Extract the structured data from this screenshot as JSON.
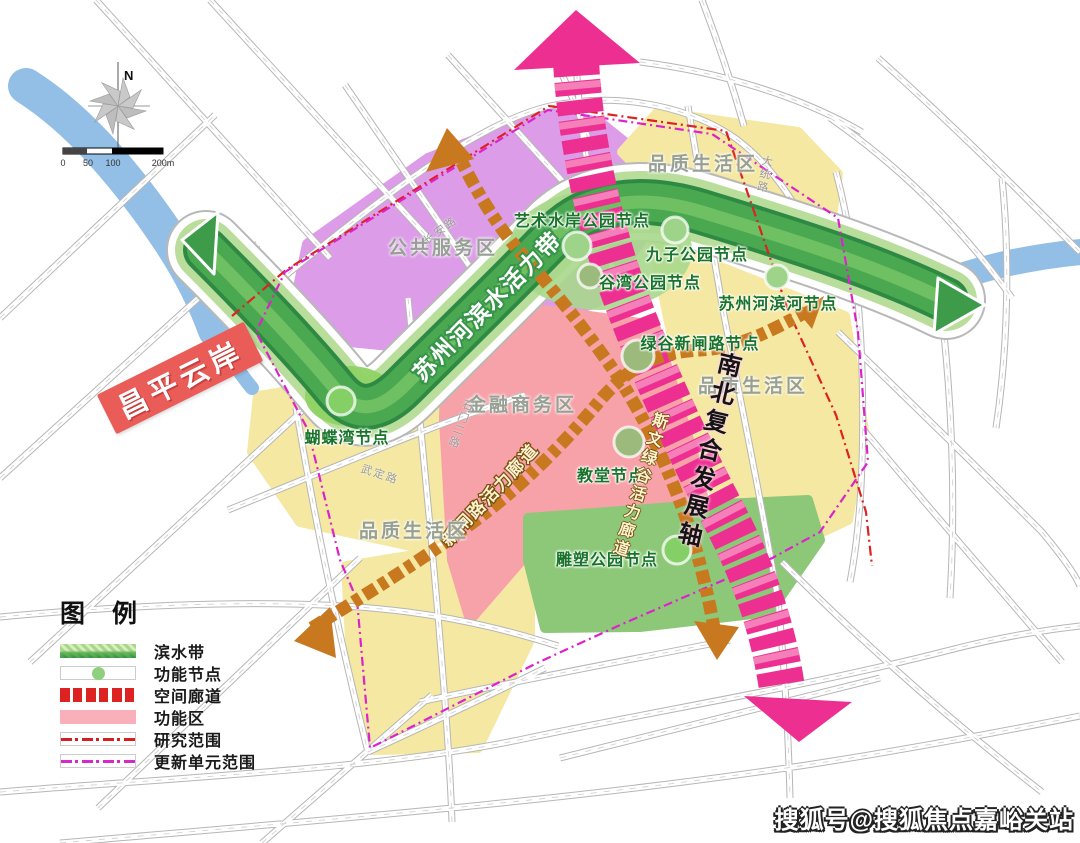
{
  "colors": {
    "river": "#93bfe6",
    "waterfront_band": "#3f9c49",
    "waterfront_band_light": "#b9dd9b",
    "axis_pink": "#ee2f92",
    "corridor_orange": "#c8791f",
    "zone_public_service": "#dc9ce8",
    "zone_quality_life": "#f5e8a3",
    "zone_finance": "#f6a2a8",
    "zone_park_green": "#8cc878",
    "node_green": "#84cf66",
    "boundary_research": "#dd2222",
    "boundary_update_unit": "#dd22cc",
    "banner_red": "#ea5c58"
  },
  "map": {
    "banner": "昌平云岸",
    "compass_north": "N",
    "scale_ticks": [
      "0",
      "50",
      "100",
      "200m"
    ],
    "waterfront_band_label": "苏州河滨水活力带",
    "axis_label": "南北复合发展轴",
    "corridor_xinzha_label": "新闸路活力廊道",
    "corridor_siwen_label": "斯文绿谷活力廊道",
    "zones": [
      {
        "label": "公共服务区"
      },
      {
        "label": "品质生活区"
      },
      {
        "label": "品质生活区"
      },
      {
        "label": "品质生活区"
      },
      {
        "label": "金融商务区"
      }
    ],
    "nodes": [
      {
        "label": "艺术水岸公园节点"
      },
      {
        "label": "九子公园节点"
      },
      {
        "label": "谷湾公园节点"
      },
      {
        "label": "苏州河滨河节点"
      },
      {
        "label": "绿谷新闸路节点"
      },
      {
        "label": "教堂节点"
      },
      {
        "label": "雕塑公园节点"
      },
      {
        "label": "蝴蝶湾节点"
      }
    ],
    "roads": [
      {
        "label": "长安路"
      },
      {
        "label": "大统路"
      },
      {
        "label": "石门二路"
      },
      {
        "label": "武定路"
      }
    ]
  },
  "legend": {
    "title": "图 例",
    "items": [
      {
        "label": "滨水带"
      },
      {
        "label": "功能节点"
      },
      {
        "label": "空间廊道"
      },
      {
        "label": "功能区"
      },
      {
        "label": "研究范围"
      },
      {
        "label": "更新单元范围"
      }
    ]
  },
  "watermark": "搜狐号@搜狐焦点嘉峪关站"
}
